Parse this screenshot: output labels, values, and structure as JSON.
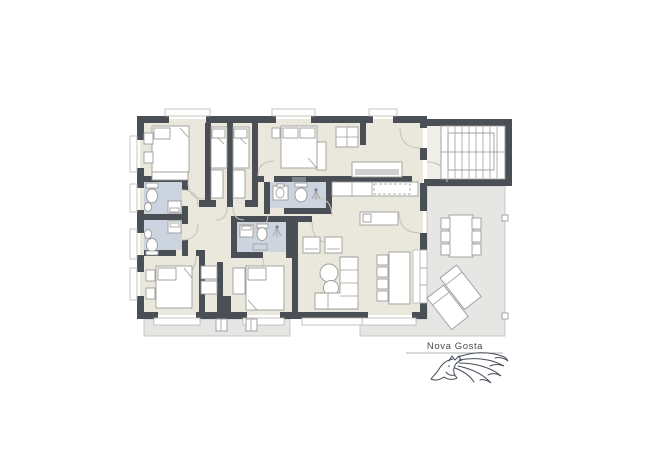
{
  "brand": {
    "name": "Nova Gosta"
  },
  "colors": {
    "background": "#ffffff",
    "wall": "#4a4f55",
    "floor": "#eae8dd",
    "bathroom_floor": "#ccd4e0",
    "stair_hall_floor": "#efeee8",
    "terrace": "#e6e6e4",
    "terrace_border": "#c8c8c6",
    "furniture_fill": "#ffffff",
    "furniture_stroke": "#9b9b98",
    "door_arc": "#c6c2b6",
    "label_text": "#4a4a4a",
    "logo_stroke": "#454c56"
  },
  "plan": {
    "rooms": [
      "bedroom",
      "bedroom",
      "bedroom",
      "bedroom",
      "bedroom",
      "bathroom",
      "bathroom",
      "bathroom",
      "bathroom",
      "kitchen",
      "living-dining-room",
      "hallway",
      "staircase",
      "terrace",
      "patio"
    ],
    "furniture_icons": [
      "double-bed-icon",
      "single-bed-icon",
      "wardrobe-icon",
      "nightstand-icon",
      "toilet-icon",
      "sink-icon",
      "washing-machine-icon",
      "shower-icon",
      "kitchen-counter-icon",
      "kitchen-table-icon",
      "dining-table-icon",
      "chair-icon",
      "sofa-icon",
      "armchair-icon",
      "coffee-table-icon",
      "sideboard-icon",
      "outdoor-dining-set-icon",
      "sun-lounger-icon",
      "stair-treads-icon"
    ]
  },
  "logo": {
    "description": "horse-head-with-flowing-mane"
  }
}
